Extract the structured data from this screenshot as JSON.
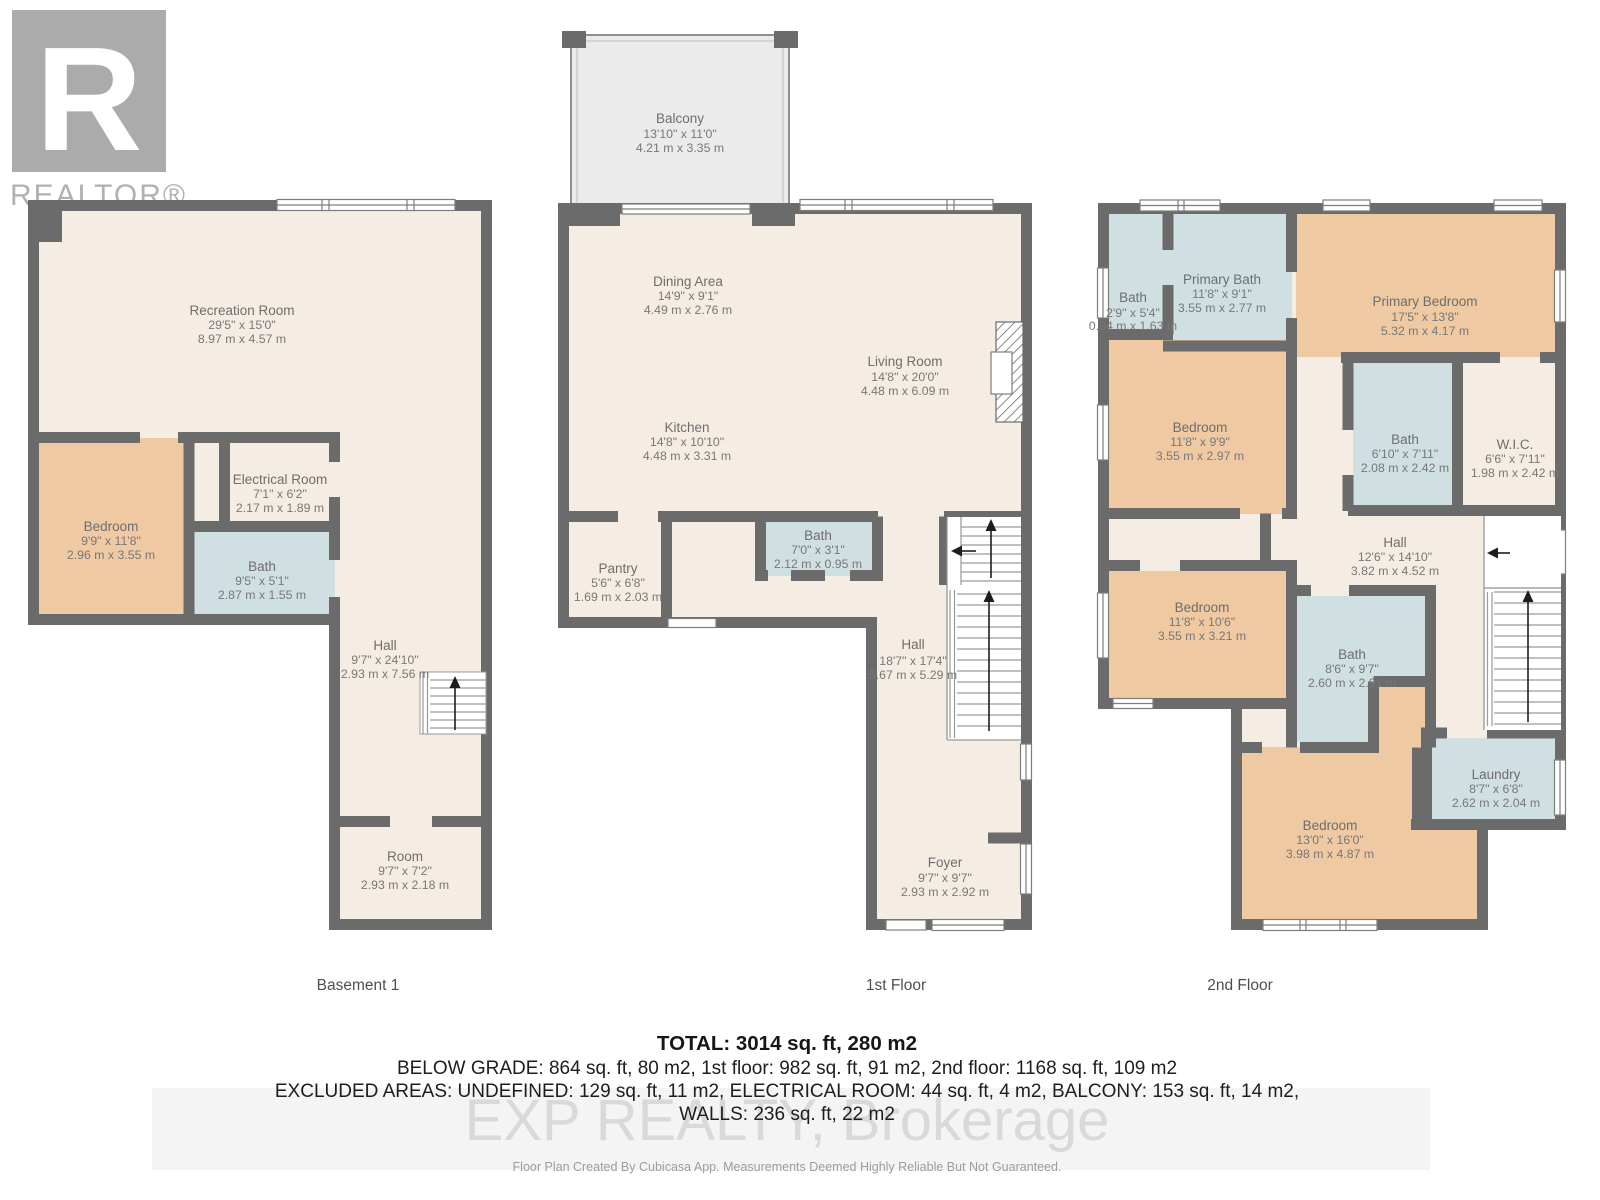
{
  "brand": {
    "logo_letter": "R",
    "logo_text": "REALTOR®"
  },
  "floors": [
    {
      "label": "Basement 1",
      "rooms": [
        {
          "name": "Recreation Room",
          "imperial": "29'5\" x 15'0\"",
          "metric": "8.97 m x 4.57 m"
        },
        {
          "name": "Bedroom",
          "imperial": "9'9\" x 11'8\"",
          "metric": "2.96 m x 3.55 m"
        },
        {
          "name": "Electrical Room",
          "imperial": "7'1\" x 6'2\"",
          "metric": "2.17 m x 1.89 m"
        },
        {
          "name": "Bath",
          "imperial": "9'5\" x 5'1\"",
          "metric": "2.87 m x 1.55 m"
        },
        {
          "name": "Hall",
          "imperial": "9'7\" x 24'10\"",
          "metric": "2.93 m x 7.56 m"
        },
        {
          "name": "Room",
          "imperial": "9'7\" x 7'2\"",
          "metric": "2.93 m x 2.18 m"
        }
      ]
    },
    {
      "label": "1st Floor",
      "rooms": [
        {
          "name": "Balcony",
          "imperial": "13'10\" x 11'0\"",
          "metric": "4.21 m x 3.35 m"
        },
        {
          "name": "Dining Area",
          "imperial": "14'9\" x 9'1\"",
          "metric": "4.49 m x 2.76 m"
        },
        {
          "name": "Living Room",
          "imperial": "14'8\" x 20'0\"",
          "metric": "4.48 m x 6.09 m"
        },
        {
          "name": "Kitchen",
          "imperial": "14'8\" x 10'10\"",
          "metric": "4.48 m x 3.31 m"
        },
        {
          "name": "Bath",
          "imperial": "7'0\" x 3'1\"",
          "metric": "2.12 m x 0.95 m"
        },
        {
          "name": "Pantry",
          "imperial": "5'6\" x 6'8\"",
          "metric": "1.69 m x 2.03 m"
        },
        {
          "name": "Hall",
          "imperial": "18'7\" x 17'4\"",
          "metric": "5.67 m x 5.29 m"
        },
        {
          "name": "Foyer",
          "imperial": "9'7\" x 9'7\"",
          "metric": "2.93 m x 2.92 m"
        }
      ]
    },
    {
      "label": "2nd Floor",
      "rooms": [
        {
          "name": "Bath",
          "imperial": "2'9\" x 5'4\"",
          "metric": "0.84 m x 1.63 m"
        },
        {
          "name": "Primary Bath",
          "imperial": "11'8\" x 9'1\"",
          "metric": "3.55 m x 2.77 m"
        },
        {
          "name": "Primary Bedroom",
          "imperial": "17'5\" x 13'8\"",
          "metric": "5.32 m x 4.17 m"
        },
        {
          "name": "Bedroom",
          "imperial": "11'8\" x 9'9\"",
          "metric": "3.55 m x 2.97 m"
        },
        {
          "name": "Bath",
          "imperial": "6'10\" x 7'11\"",
          "metric": "2.08 m x 2.42 m"
        },
        {
          "name": "W.I.C.",
          "imperial": "6'6\" x 7'11\"",
          "metric": "1.98 m x 2.42 m"
        },
        {
          "name": "Hall",
          "imperial": "12'6\" x 14'10\"",
          "metric": "3.82 m x 4.52 m"
        },
        {
          "name": "Bedroom",
          "imperial": "11'8\" x 10'6\"",
          "metric": "3.55 m x 3.21 m"
        },
        {
          "name": "Bath",
          "imperial": "8'6\" x 9'7\"",
          "metric": "2.60 m x 2.91 m"
        },
        {
          "name": "Laundry",
          "imperial": "8'7\" x 6'8\"",
          "metric": "2.62 m x 2.04 m"
        },
        {
          "name": "Bedroom",
          "imperial": "13'0\" x 16'0\"",
          "metric": "3.98 m x 4.87 m"
        }
      ]
    }
  ],
  "summary": {
    "total": "TOTAL: 3014 sq. ft, 280 m2",
    "floors_line": "BELOW GRADE: 864 sq. ft, 80 m2, 1st floor: 982 sq. ft, 91 m2, 2nd floor: 1168 sq. ft, 109 m2",
    "excluded_line": "EXCLUDED AREAS: UNDEFINED: 129 sq. ft, 11 m2, ELECTRICAL ROOM: 44 sq. ft, 4 m2, BALCONY: 153 sq. ft, 14 m2,",
    "walls_line": "WALLS: 236 sq. ft, 22 m2"
  },
  "watermark": "EXP REALTY, Brokerage",
  "disclaimer": "Floor Plan Created By Cubicasa App. Measurements Deemed Highly Reliable But Not Guaranteed.",
  "colors": {
    "wall": "#6b6b6b",
    "floor": "#f5ece4",
    "bedroom": "#eec9a2",
    "bath": "#cfdfe2",
    "balcony": "#ebebeb"
  }
}
